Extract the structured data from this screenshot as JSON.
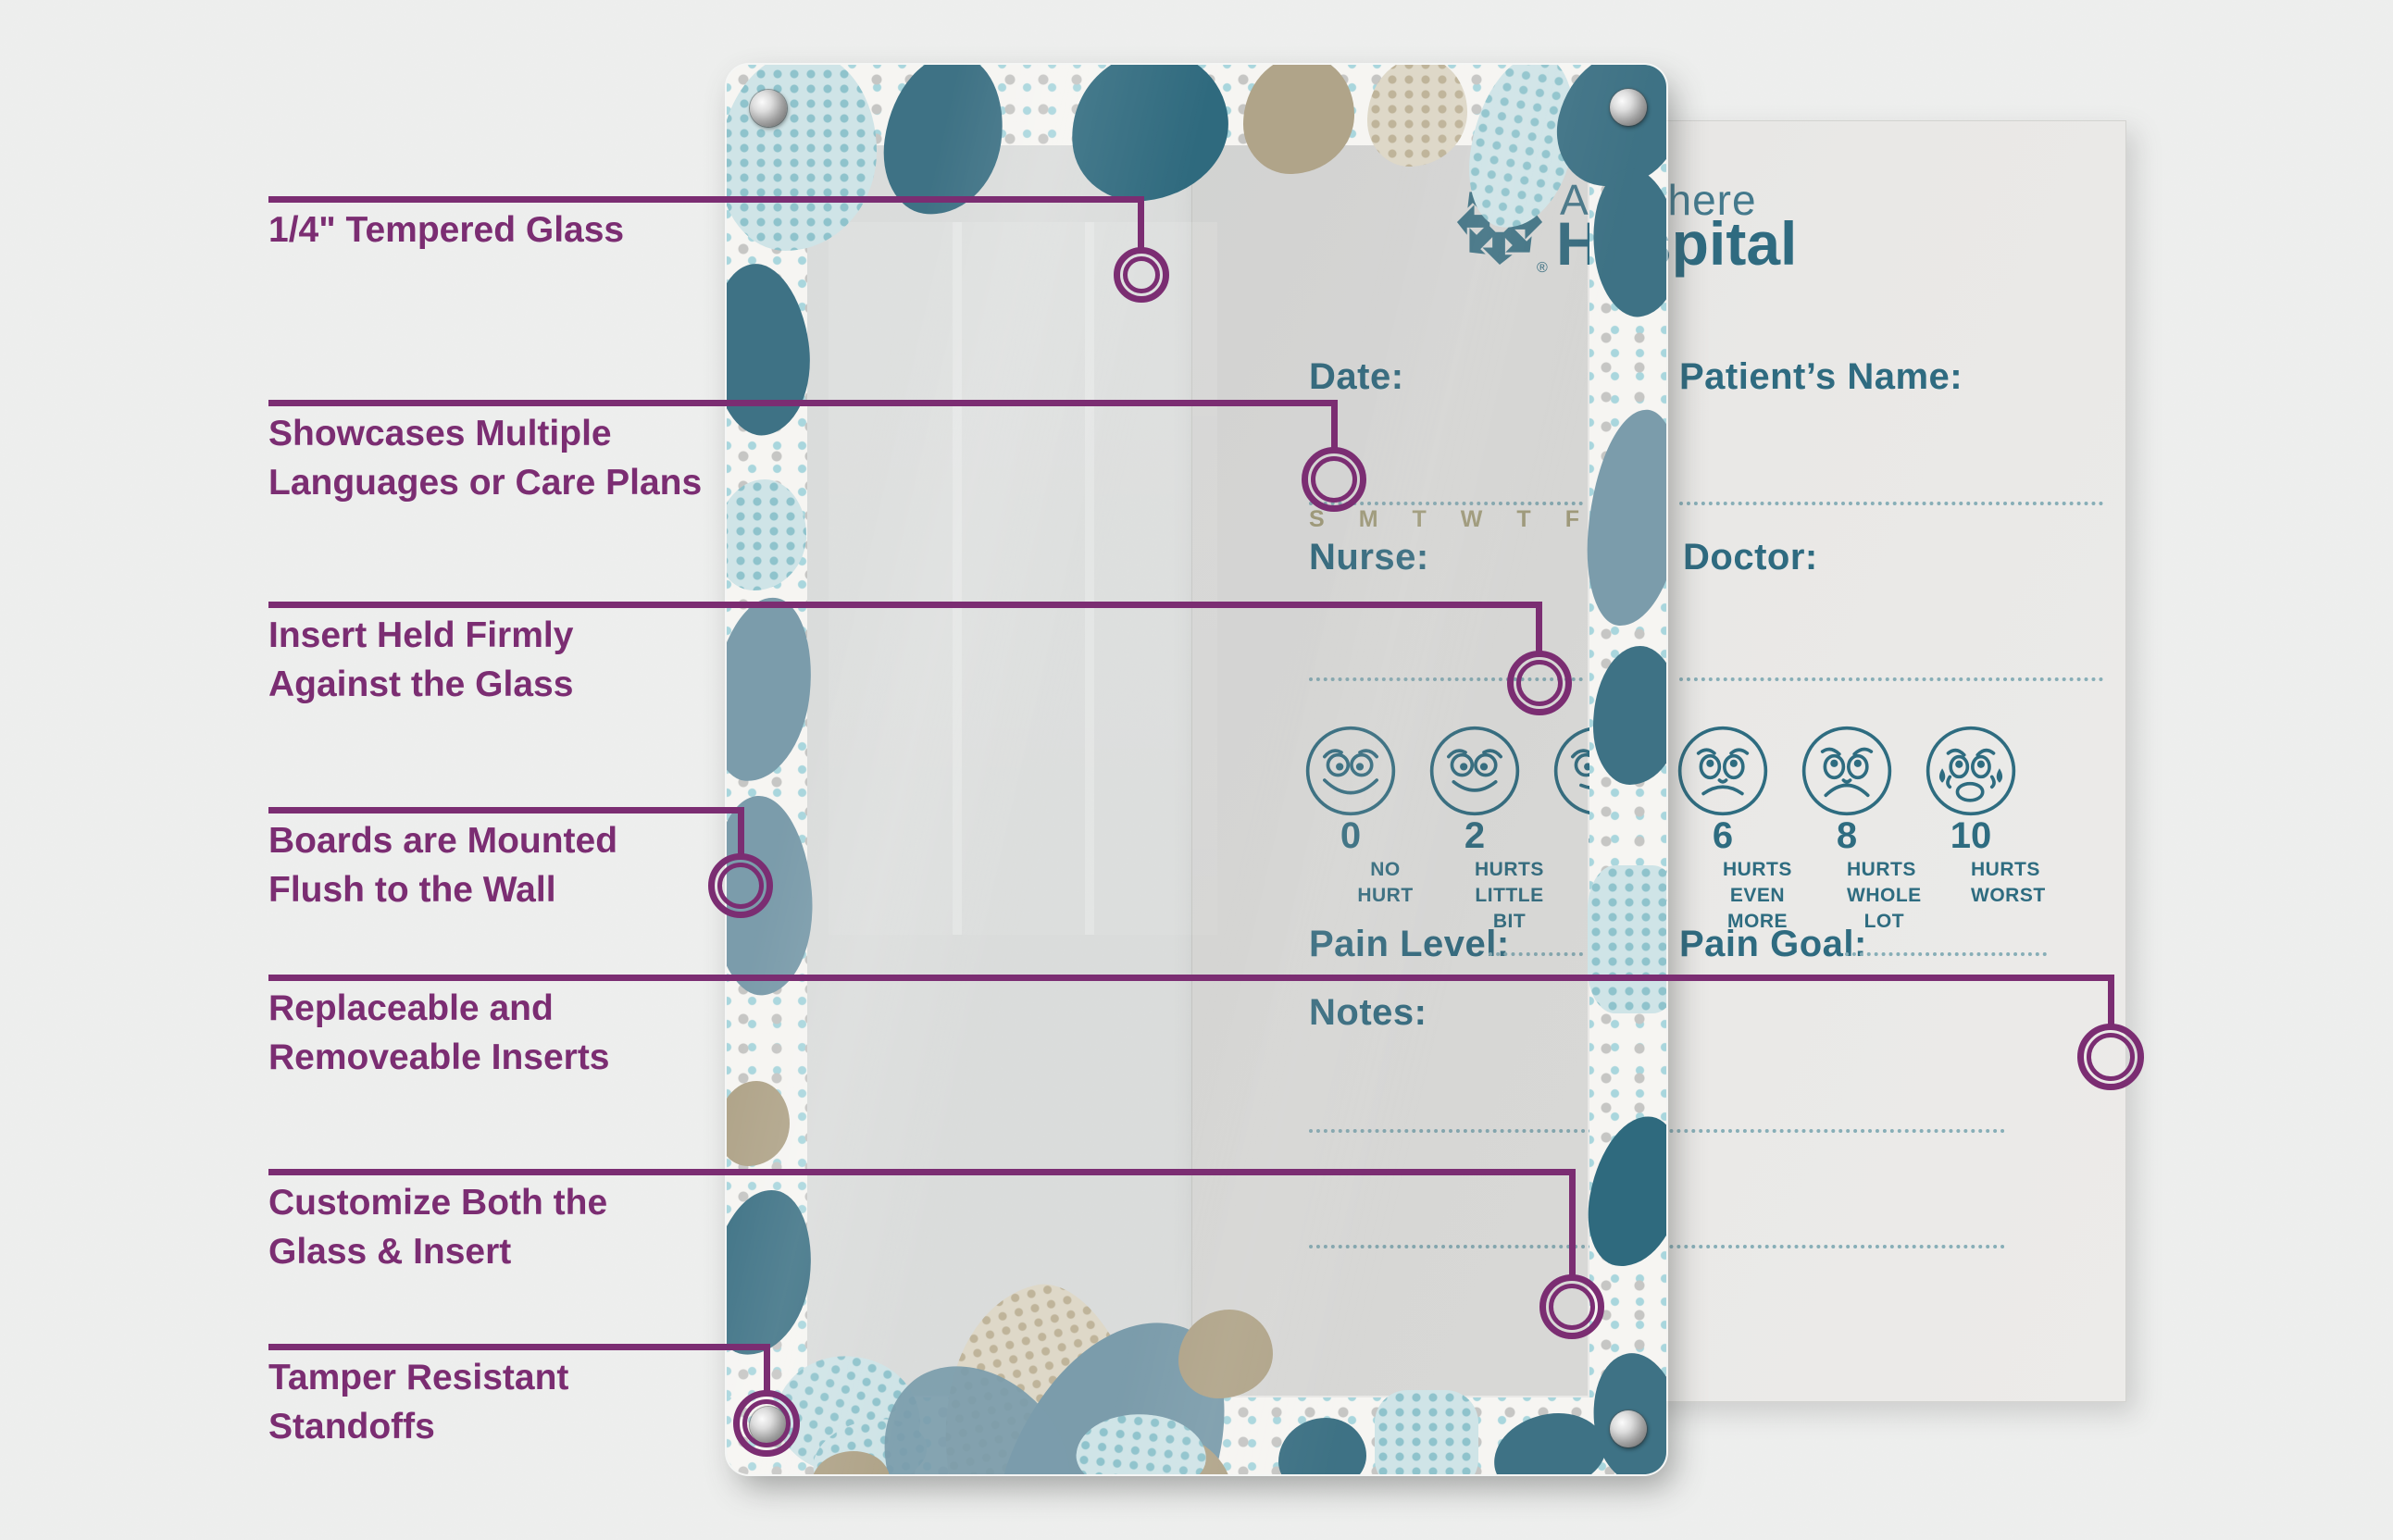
{
  "page": {
    "background": "#edeeed",
    "accent_purple": "#7b2d72",
    "teal": "#2f6b80"
  },
  "callouts": {
    "color": "#7b2d72",
    "items": [
      {
        "line1": "1/4\" Tempered Glass",
        "line2": ""
      },
      {
        "line1": "Showcases Multiple",
        "line2": "Languages or Care Plans"
      },
      {
        "line1": "Insert Held Firmly",
        "line2": "Against the Glass"
      },
      {
        "line1": "Boards are Mounted",
        "line2": "Flush to the Wall"
      },
      {
        "line1": "Replaceable and",
        "line2": "Removeable Inserts"
      },
      {
        "line1": "Customize Both the",
        "line2": "Glass & Insert"
      },
      {
        "line1": "Tamper Resistant",
        "line2": "Standoffs"
      }
    ]
  },
  "brand": {
    "word_top": "Anywhere",
    "word_bottom": "Hospital",
    "registered": "®",
    "color": "#2f6b80"
  },
  "insert": {
    "date_label": "Date:",
    "patient_label": "Patient’s Name:",
    "nurse_label": "Nurse:",
    "doctor_label": "Doctor:",
    "pain_level_label": "Pain Level:",
    "pain_goal_label": "Pain Goal:",
    "notes_label": "Notes:",
    "days": [
      "S",
      "M",
      "T",
      "W",
      "T",
      "F"
    ],
    "text_color": "#2f6b80",
    "days_color": "#a7a07c"
  },
  "pain_scale": {
    "items": [
      {
        "value": "0",
        "label1": "NO HURT",
        "label2": ""
      },
      {
        "value": "2",
        "label1": "HURTS",
        "label2": "LITTLE BIT"
      },
      {
        "value": "4",
        "label1": "HURTS",
        "label2": "LITTLE MORE"
      },
      {
        "value": "6",
        "label1": "HURTS",
        "label2": "EVEN MORE"
      },
      {
        "value": "8",
        "label1": "HURTS",
        "label2": "WHOLE LOT"
      },
      {
        "value": "10",
        "label1": "HURTS",
        "label2": "WORST"
      }
    ]
  }
}
